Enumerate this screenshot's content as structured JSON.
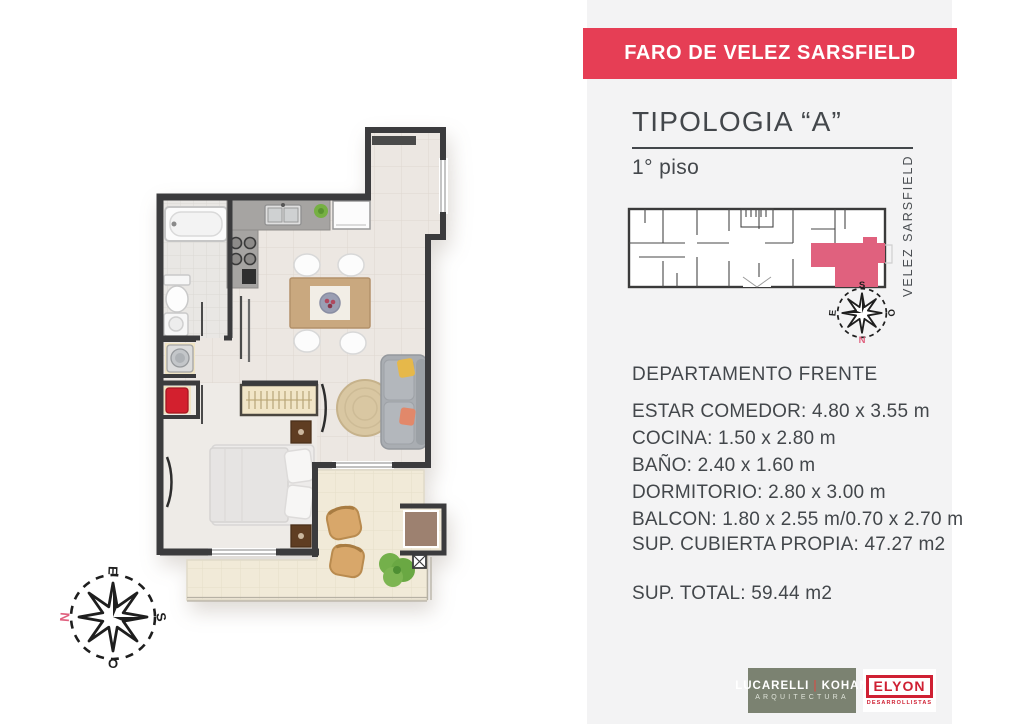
{
  "header": {
    "project_title": "FARO DE VELEZ SARSFIELD"
  },
  "panel": {
    "typology_title": "TIPOLOGIA “A”",
    "floor_label": "1° piso",
    "street_label": "VELEZ SARSFIELD",
    "unit_type": "DEPARTAMENTO FRENTE",
    "dimensions": [
      "ESTAR COMEDOR: 4.80 x 3.55 m",
      "COCINA: 1.50 x 2.80 m",
      "BAÑO: 2.40 x 1.60 m",
      "DORMITORIO: 2.80 x 3.00 m",
      "BALCON: 1.80 x 2.55 m/0.70 x 2.70 m"
    ],
    "covered_area_label": "SUP. CUBIERTA PROPIA: 47.27 m2",
    "total_area_label": "SUP. TOTAL: 59.44 m2"
  },
  "compass_plan": {
    "top": "E",
    "right": "S",
    "bottom": "O",
    "left": "N"
  },
  "compass_key": {
    "top": "S",
    "right": "O",
    "bottom": "N",
    "left": "E"
  },
  "logos": {
    "architecture": {
      "name_left": "LUCARELLI",
      "divider": "|",
      "name_right": "KOHAN",
      "subtitle": "ARQUITECTURA"
    },
    "developer": {
      "name": "ELYON",
      "subtitle": "DESARROLLISTAS"
    }
  },
  "colors": {
    "banner_red": "#e63e55",
    "highlight_pink": "#e0617e",
    "panel_bg": "#f3f3f4",
    "text_dark": "#43474b",
    "wall_dark": "#3b3b3d",
    "architecture_logo_bg": "#7b8271",
    "developer_logo_red": "#cf2033"
  }
}
